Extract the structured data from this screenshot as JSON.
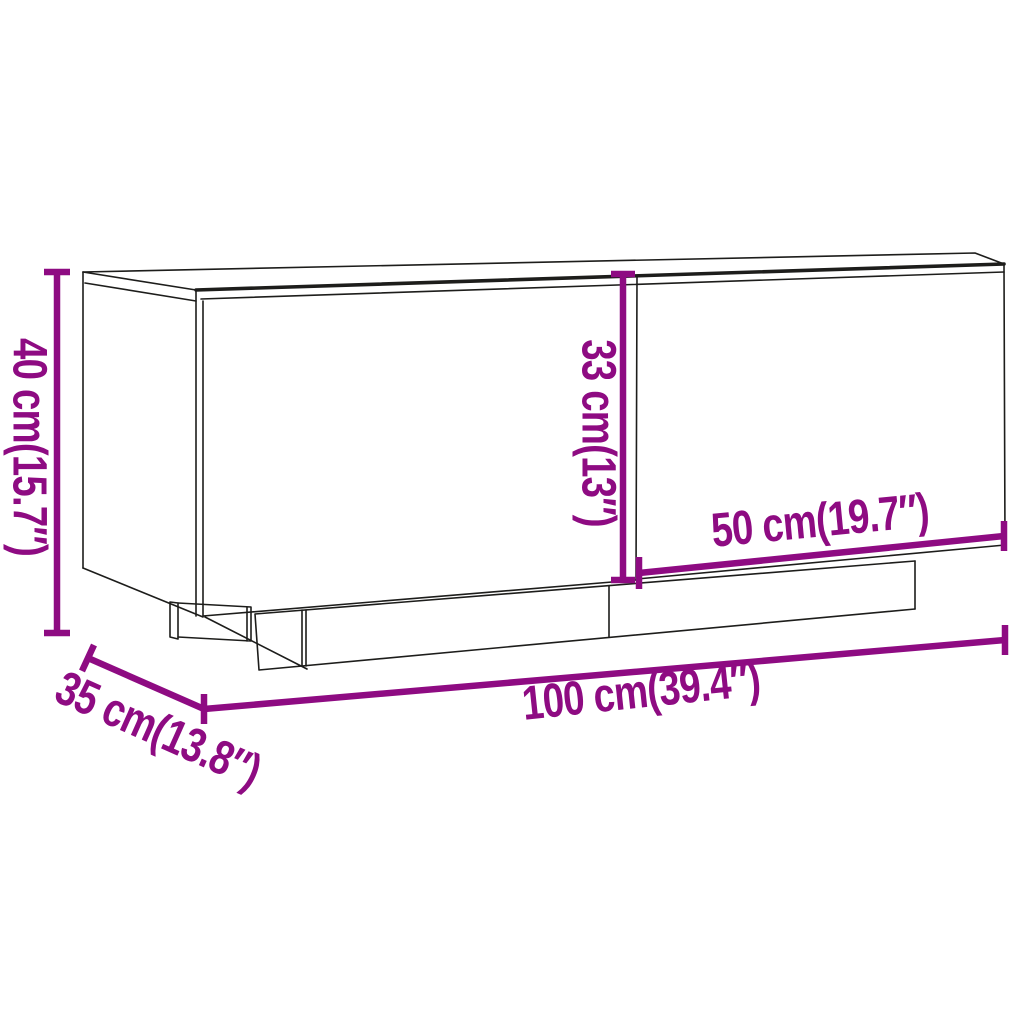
{
  "subject": "tv-cabinet-line-drawing",
  "dimension_labels": {
    "height": "40 cm(15.7″)",
    "depth": "35 cm(13.8″)",
    "width": "100 cm(39.4″)",
    "door_width": "50 cm(19.7″)",
    "door_height": "33 cm(13″)"
  },
  "dimensions": [
    {
      "name": "height",
      "cm": 40,
      "inches": 15.7
    },
    {
      "name": "depth",
      "cm": 35,
      "inches": 13.8
    },
    {
      "name": "width",
      "cm": 100,
      "inches": 39.4
    },
    {
      "name": "door_width",
      "cm": 50,
      "inches": 19.7
    },
    {
      "name": "door_height",
      "cm": 33,
      "inches": 13
    }
  ],
  "colors": {
    "dimension": "#8e0b82",
    "line": "#1d1d1b",
    "background": "#ffffff"
  }
}
